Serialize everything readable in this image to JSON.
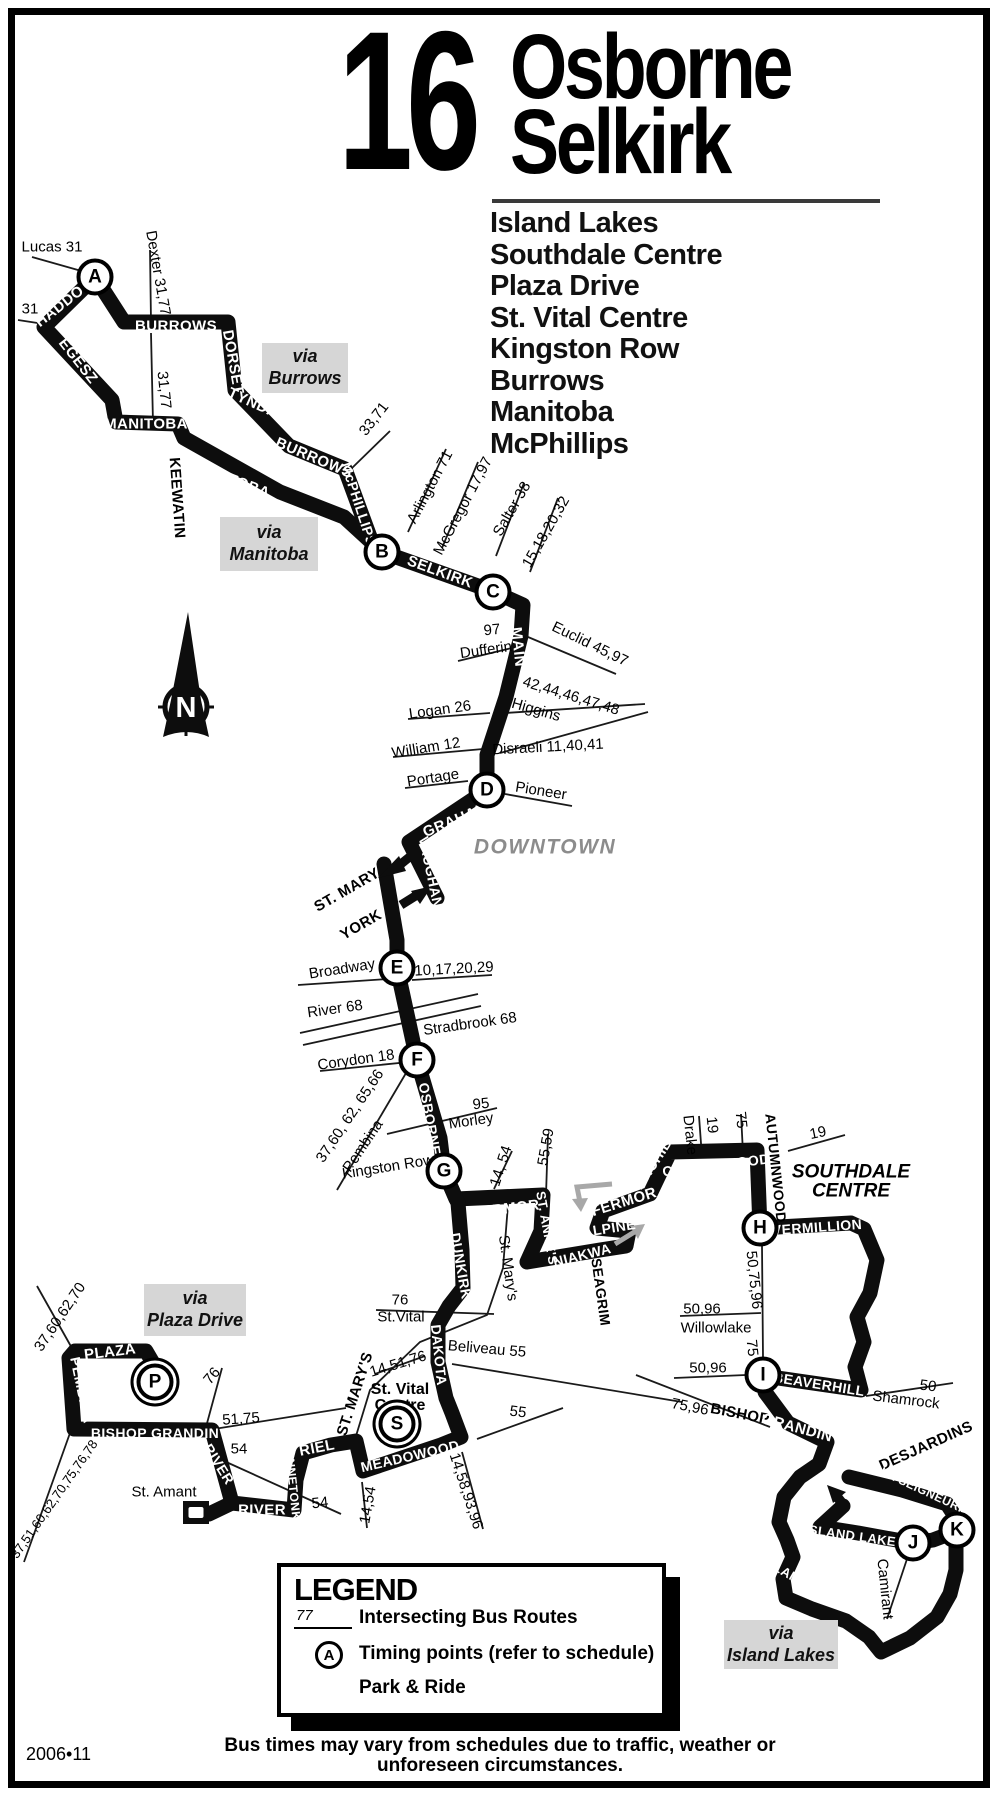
{
  "title": {
    "route_number": "16",
    "name_line1": "Osborne",
    "name_line2": "Selkirk"
  },
  "destinations": [
    "Island Lakes",
    "Southdale Centre",
    "Plaza Drive",
    "St. Vital Centre",
    "Kingston Row",
    "Burrows",
    "Manitoba",
    "McPhillips"
  ],
  "colors": {
    "route": "#0d0d0d",
    "via_box_bg": "#d6d6d6",
    "district_gray": "#8c8c8c",
    "arrow_gray": "#a8a8a8"
  },
  "map": {
    "via_boxes": [
      {
        "lines": [
          "via",
          "Burrows"
        ],
        "x": 262,
        "y": 343,
        "w": 86,
        "h": 50
      },
      {
        "lines": [
          "via",
          "Manitoba"
        ],
        "x": 220,
        "y": 517,
        "w": 98,
        "h": 54
      },
      {
        "lines": [
          "via",
          "Plaza Drive"
        ],
        "x": 144,
        "y": 1284,
        "w": 102,
        "h": 52
      },
      {
        "lines": [
          "via",
          "Island Lakes"
        ],
        "x": 724,
        "y": 1620,
        "w": 114,
        "h": 49
      }
    ],
    "timing_points": [
      {
        "id": "A",
        "x": 95,
        "y": 277,
        "ring": false
      },
      {
        "id": "B",
        "x": 382,
        "y": 552,
        "ring": false
      },
      {
        "id": "C",
        "x": 493,
        "y": 592,
        "ring": false
      },
      {
        "id": "D",
        "x": 487,
        "y": 790,
        "ring": false
      },
      {
        "id": "E",
        "x": 397,
        "y": 968,
        "ring": false
      },
      {
        "id": "F",
        "x": 417,
        "y": 1060,
        "ring": false
      },
      {
        "id": "G",
        "x": 444,
        "y": 1171,
        "ring": false
      },
      {
        "id": "H",
        "x": 760,
        "y": 1228,
        "ring": false
      },
      {
        "id": "I",
        "x": 763,
        "y": 1375,
        "ring": false
      },
      {
        "id": "J",
        "x": 913,
        "y": 1543,
        "ring": false
      },
      {
        "id": "K",
        "x": 957,
        "y": 1530,
        "ring": false
      },
      {
        "id": "P",
        "x": 155,
        "y": 1382,
        "ring": true
      },
      {
        "id": "S",
        "x": 397,
        "y": 1424,
        "ring": true
      }
    ],
    "labels": [
      {
        "t": "Lucas 31",
        "x": 52,
        "y": 247,
        "r": 0,
        "c": "mn"
      },
      {
        "t": "31",
        "x": 30,
        "y": 309,
        "r": 0,
        "c": "mn"
      },
      {
        "t": "HADDON",
        "x": 64,
        "y": 303,
        "r": -38,
        "c": "rt"
      },
      {
        "t": "EGESZ",
        "x": 78,
        "y": 361,
        "r": 52,
        "c": "rt"
      },
      {
        "t": "BURROWS",
        "x": 176,
        "y": 326,
        "r": 0,
        "c": "rt"
      },
      {
        "t": "Dexter 31,77",
        "x": 158,
        "y": 273,
        "r": 80,
        "c": "mn"
      },
      {
        "t": "DORSET",
        "x": 233,
        "y": 362,
        "r": 80,
        "c": "rt"
      },
      {
        "t": "TYNDALL",
        "x": 262,
        "y": 407,
        "r": 24,
        "c": "rt"
      },
      {
        "t": "31,77",
        "x": 164,
        "y": 390,
        "r": 84,
        "c": "mn"
      },
      {
        "t": "MANITOBA",
        "x": 146,
        "y": 424,
        "r": 0,
        "c": "rt"
      },
      {
        "t": "KEEWATIN",
        "x": 177,
        "y": 498,
        "r": 86,
        "c": "st"
      },
      {
        "t": "MANITOBA",
        "x": 230,
        "y": 479,
        "r": 21,
        "c": "rt"
      },
      {
        "t": "BURROWS",
        "x": 314,
        "y": 458,
        "r": 23,
        "c": "rt"
      },
      {
        "t": "McPHILLIPS",
        "x": 359,
        "y": 504,
        "r": 72,
        "c": "rt",
        "s": 14
      },
      {
        "t": "33,71",
        "x": 374,
        "y": 419,
        "r": -52,
        "c": "mn"
      },
      {
        "t": "SELKIRK",
        "x": 440,
        "y": 572,
        "r": 20,
        "c": "rt"
      },
      {
        "t": "Arlington 71",
        "x": 430,
        "y": 487,
        "r": -62,
        "c": "mn"
      },
      {
        "t": "McGregor 17,97",
        "x": 463,
        "y": 506,
        "r": -62,
        "c": "mn"
      },
      {
        "t": "Salter 38",
        "x": 512,
        "y": 509,
        "r": -60,
        "c": "mn"
      },
      {
        "t": "15,18,20,32",
        "x": 546,
        "y": 532,
        "r": -60,
        "c": "mn"
      },
      {
        "t": "97",
        "x": 492,
        "y": 630,
        "r": -6,
        "c": "mn"
      },
      {
        "t": "Dufferin",
        "x": 486,
        "y": 650,
        "r": -8,
        "c": "mn"
      },
      {
        "t": "MAIN",
        "x": 518,
        "y": 647,
        "r": 84,
        "c": "rt"
      },
      {
        "t": "Euclid 45,97",
        "x": 590,
        "y": 644,
        "r": 26,
        "c": "mn"
      },
      {
        "t": "42,44,46,47,48",
        "x": 571,
        "y": 696,
        "r": 17,
        "c": "mn"
      },
      {
        "t": "Higgins",
        "x": 536,
        "y": 710,
        "r": 16,
        "c": "mn"
      },
      {
        "t": "Logan 26",
        "x": 440,
        "y": 710,
        "r": -8,
        "c": "mn"
      },
      {
        "t": "William 12",
        "x": 426,
        "y": 748,
        "r": -9,
        "c": "mn"
      },
      {
        "t": "Disraeli 11,40,41",
        "x": 548,
        "y": 747,
        "r": -3,
        "c": "mn"
      },
      {
        "t": "Portage",
        "x": 433,
        "y": 778,
        "r": -9,
        "c": "mn"
      },
      {
        "t": "Pioneer",
        "x": 541,
        "y": 791,
        "r": 9,
        "c": "mn"
      },
      {
        "t": "GRAHAM",
        "x": 456,
        "y": 820,
        "r": -22,
        "c": "rt"
      },
      {
        "t": "VAUGHAN",
        "x": 431,
        "y": 872,
        "r": 78,
        "c": "rt",
        "s": 14
      },
      {
        "t": "DOWNTOWN",
        "x": 545,
        "y": 847,
        "r": 0,
        "c": "dt"
      },
      {
        "t": "ST. MARY",
        "x": 347,
        "y": 890,
        "r": -30,
        "c": "st"
      },
      {
        "t": "YORK",
        "x": 361,
        "y": 925,
        "r": -30,
        "c": "st"
      },
      {
        "t": "Broadway",
        "x": 342,
        "y": 969,
        "r": -9,
        "c": "mn"
      },
      {
        "t": "10,17,20,29",
        "x": 454,
        "y": 969,
        "r": -3,
        "c": "mn"
      },
      {
        "t": "River 68",
        "x": 335,
        "y": 1009,
        "r": -8,
        "c": "mn"
      },
      {
        "t": "Stradbrook 68",
        "x": 470,
        "y": 1024,
        "r": -8,
        "c": "mn"
      },
      {
        "t": "Corydon 18",
        "x": 356,
        "y": 1060,
        "r": -8,
        "c": "mn"
      },
      {
        "t": "OSBORNE",
        "x": 430,
        "y": 1119,
        "r": 80,
        "c": "rt",
        "s": 14
      },
      {
        "t": "37,60, 62, 65,66",
        "x": 350,
        "y": 1116,
        "r": -56,
        "c": "mn"
      },
      {
        "t": "Pembina",
        "x": 363,
        "y": 1146,
        "r": -56,
        "c": "mn"
      },
      {
        "t": "95",
        "x": 481,
        "y": 1104,
        "r": -6,
        "c": "mn"
      },
      {
        "t": "Morley",
        "x": 471,
        "y": 1121,
        "r": -8,
        "c": "mn"
      },
      {
        "t": "Kingston Row",
        "x": 388,
        "y": 1167,
        "r": -9,
        "c": "mn"
      },
      {
        "t": "14, 54",
        "x": 501,
        "y": 1166,
        "r": -72,
        "c": "mn"
      },
      {
        "t": "FERMOR",
        "x": 506,
        "y": 1209,
        "r": -7,
        "c": "rt"
      },
      {
        "t": "55,59",
        "x": 546,
        "y": 1147,
        "r": -80,
        "c": "mn"
      },
      {
        "t": "ST. ANNE'S",
        "x": 547,
        "y": 1228,
        "r": 80,
        "c": "rt",
        "s": 13
      },
      {
        "t": "NIAKWA",
        "x": 582,
        "y": 1255,
        "r": -14,
        "c": "rt",
        "s": 14
      },
      {
        "t": "ALPINE",
        "x": 609,
        "y": 1228,
        "r": -9,
        "c": "rt",
        "s": 14
      },
      {
        "t": "FERMOR",
        "x": 624,
        "y": 1202,
        "r": -17,
        "c": "rt"
      },
      {
        "t": "SEAGRIM",
        "x": 601,
        "y": 1292,
        "r": 82,
        "c": "st",
        "s": 14
      },
      {
        "t": "ARCHIBALD",
        "x": 661,
        "y": 1151,
        "r": -57,
        "c": "rt",
        "s": 14
      },
      {
        "t": "Drake",
        "x": 690,
        "y": 1135,
        "r": 84,
        "c": "mn"
      },
      {
        "t": "19",
        "x": 712,
        "y": 1125,
        "r": 84,
        "c": "mn"
      },
      {
        "t": "75",
        "x": 741,
        "y": 1120,
        "r": 84,
        "c": "mn"
      },
      {
        "t": "COTTONWOOD",
        "x": 716,
        "y": 1165,
        "r": -7,
        "c": "rt",
        "s": 14
      },
      {
        "t": "AUTUMNWOOD",
        "x": 776,
        "y": 1168,
        "r": 84,
        "c": "st",
        "s": 14
      },
      {
        "t": "19",
        "x": 818,
        "y": 1133,
        "r": -12,
        "c": "mn"
      },
      {
        "t": "SOUTHDALE",
        "x": 851,
        "y": 1172,
        "r": 0,
        "c": "sd"
      },
      {
        "t": "CENTRE",
        "x": 851,
        "y": 1191,
        "r": 0,
        "c": "sd"
      },
      {
        "t": "VERMILLION",
        "x": 817,
        "y": 1227,
        "r": -4,
        "c": "rt",
        "s": 14
      },
      {
        "t": "50,75,96",
        "x": 754,
        "y": 1280,
        "r": 84,
        "c": "mn"
      },
      {
        "t": "75",
        "x": 752,
        "y": 1348,
        "r": 84,
        "c": "mn"
      },
      {
        "t": "50,96",
        "x": 702,
        "y": 1309,
        "r": 0,
        "c": "mn"
      },
      {
        "t": "Willowlake",
        "x": 716,
        "y": 1328,
        "r": 0,
        "c": "mn"
      },
      {
        "t": "50,96",
        "x": 708,
        "y": 1368,
        "r": 0,
        "c": "mn"
      },
      {
        "t": "BEAVERHILL",
        "x": 819,
        "y": 1384,
        "r": 9,
        "c": "rt",
        "s": 14
      },
      {
        "t": "50",
        "x": 928,
        "y": 1386,
        "r": 7,
        "c": "mn"
      },
      {
        "t": "Shamrock",
        "x": 906,
        "y": 1400,
        "r": 7,
        "c": "mn"
      },
      {
        "t": "75,96",
        "x": 690,
        "y": 1407,
        "r": 11,
        "c": "mn"
      },
      {
        "t": "BISHOP",
        "x": 740,
        "y": 1414,
        "r": 11,
        "c": "st"
      },
      {
        "t": "GRANDIN",
        "x": 797,
        "y": 1428,
        "r": 15,
        "c": "rt"
      },
      {
        "t": "DESJARDINS",
        "x": 926,
        "y": 1446,
        "r": -24,
        "c": "st"
      },
      {
        "t": "DE LA SEIGNEURIE",
        "x": 916,
        "y": 1487,
        "r": 25,
        "c": "rt",
        "s": 12
      },
      {
        "t": "ISLAND LAKES",
        "x": 855,
        "y": 1536,
        "r": 8,
        "c": "rt",
        "s": 13
      },
      {
        "t": "Camirant",
        "x": 885,
        "y": 1589,
        "r": 84,
        "c": "mn"
      },
      {
        "t": "ISLAND SHORE",
        "x": 808,
        "y": 1585,
        "r": 30,
        "c": "rt",
        "s": 13
      },
      {
        "t": "DUNKIRK",
        "x": 461,
        "y": 1266,
        "r": 80,
        "c": "rt",
        "s": 14
      },
      {
        "t": "St. Mary's",
        "x": 508,
        "y": 1268,
        "r": 82,
        "c": "mn"
      },
      {
        "t": "76",
        "x": 400,
        "y": 1300,
        "r": 0,
        "c": "mn"
      },
      {
        "t": "St.Vital",
        "x": 401,
        "y": 1317,
        "r": 0,
        "c": "mn"
      },
      {
        "t": "DAKOTA",
        "x": 439,
        "y": 1355,
        "r": 84,
        "c": "rt",
        "s": 14
      },
      {
        "t": "Beliveau 55",
        "x": 487,
        "y": 1349,
        "r": 5,
        "c": "mn"
      },
      {
        "t": "14,51,76",
        "x": 398,
        "y": 1364,
        "r": -17,
        "c": "mn"
      },
      {
        "t": "St. Vital",
        "x": 400,
        "y": 1390,
        "r": 0,
        "c": "svc"
      },
      {
        "t": "Centre",
        "x": 400,
        "y": 1406,
        "r": 0,
        "c": "svc"
      },
      {
        "t": "MEADOWOOD",
        "x": 410,
        "y": 1456,
        "r": -13,
        "c": "rt",
        "s": 14
      },
      {
        "t": "55",
        "x": 518,
        "y": 1412,
        "r": 7,
        "c": "mn"
      },
      {
        "t": "14,58,93,96",
        "x": 466,
        "y": 1491,
        "r": 72,
        "c": "mn"
      },
      {
        "t": "14,54",
        "x": 368,
        "y": 1505,
        "r": -80,
        "c": "mn"
      },
      {
        "t": "ST. MARY'S",
        "x": 355,
        "y": 1394,
        "r": -72,
        "c": "st"
      },
      {
        "t": "RIEL",
        "x": 317,
        "y": 1448,
        "r": -11,
        "c": "rt"
      },
      {
        "t": "MINNETONKA",
        "x": 293,
        "y": 1487,
        "r": 84,
        "c": "rt",
        "s": 12
      },
      {
        "t": "RIVER",
        "x": 262,
        "y": 1510,
        "r": 0,
        "c": "rt"
      },
      {
        "t": "54",
        "x": 239,
        "y": 1449,
        "r": 0,
        "c": "mn"
      },
      {
        "t": "54",
        "x": 320,
        "y": 1503,
        "r": -6,
        "c": "mn"
      },
      {
        "t": "51,75",
        "x": 241,
        "y": 1419,
        "r": -4,
        "c": "mn"
      },
      {
        "t": "76",
        "x": 212,
        "y": 1376,
        "r": -50,
        "c": "mn"
      },
      {
        "t": "RIVER",
        "x": 219,
        "y": 1464,
        "r": 58,
        "c": "rt",
        "s": 14
      },
      {
        "t": "St. Amant",
        "x": 164,
        "y": 1492,
        "r": 0,
        "c": "mn"
      },
      {
        "t": "PEMBINA",
        "x": 82,
        "y": 1390,
        "r": 78,
        "c": "rt",
        "s": 14
      },
      {
        "t": "PLAZA",
        "x": 110,
        "y": 1352,
        "r": -7,
        "c": "rt"
      },
      {
        "t": "37,60,62,70",
        "x": 60,
        "y": 1317,
        "r": -56,
        "c": "mn"
      },
      {
        "t": "37,51,60,62,70,75,76,78",
        "x": 54,
        "y": 1499,
        "r": -55,
        "c": "mn",
        "s": 13
      },
      {
        "t": "BISHOP GRANDIN",
        "x": 155,
        "y": 1433,
        "r": 0,
        "c": "rt",
        "s": 14
      }
    ]
  },
  "legend": {
    "title": "LEGEND",
    "sample_route_number": "77",
    "intersecting_label": "Intersecting Bus Routes",
    "timing_letter": "A",
    "timing_label": "Timing points (refer to schedule)",
    "park_ride_label": "Park & Ride"
  },
  "footer": {
    "issue_date": "2006•11",
    "disclaimer_line1": "Bus times may vary from schedules due to traffic, weather or",
    "disclaimer_line2": "unforeseen circumstances."
  }
}
